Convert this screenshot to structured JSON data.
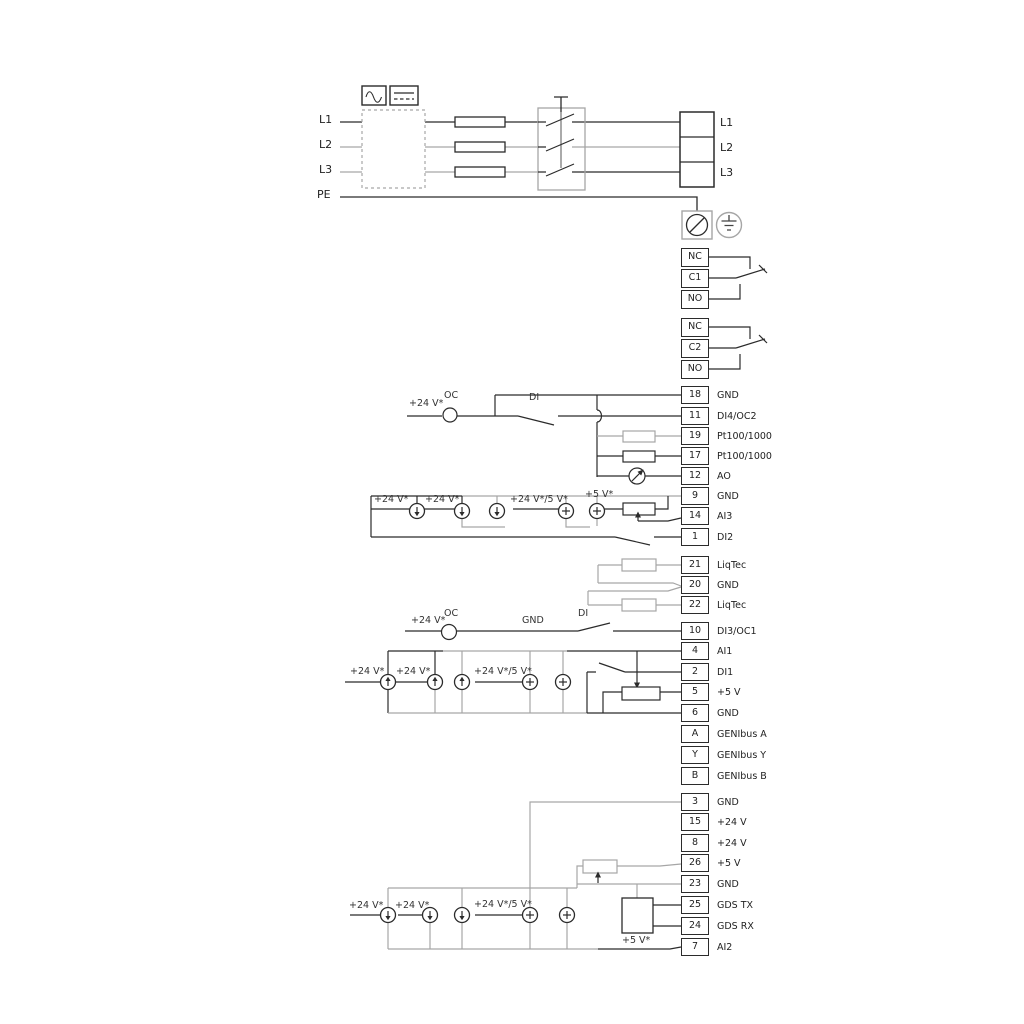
{
  "title": "Pump control wiring diagram",
  "colors": {
    "wire_dark": "#2b2b2b",
    "wire_gray": "#a6a6a6",
    "background": "#ffffff"
  },
  "power": {
    "left_labels": [
      "L1",
      "L2",
      "L3",
      "PE"
    ],
    "right_labels": [
      "L1",
      "L2",
      "L3"
    ]
  },
  "relays": {
    "relay1": [
      "NC",
      "C1",
      "NO"
    ],
    "relay2": [
      "NC",
      "C2",
      "NO"
    ]
  },
  "terminals": [
    {
      "num": "18",
      "label": "GND"
    },
    {
      "num": "11",
      "label": "DI4/OC2"
    },
    {
      "num": "19",
      "label": "Pt100/1000"
    },
    {
      "num": "17",
      "label": "Pt100/1000"
    },
    {
      "num": "12",
      "label": "AO"
    },
    {
      "num": "9",
      "label": "GND"
    },
    {
      "num": "14",
      "label": "AI3"
    },
    {
      "num": "1",
      "label": "DI2"
    },
    {
      "num": "21",
      "label": "LiqTec"
    },
    {
      "num": "20",
      "label": "GND"
    },
    {
      "num": "22",
      "label": "LiqTec"
    },
    {
      "num": "10",
      "label": "DI3/OC1"
    },
    {
      "num": "4",
      "label": "AI1"
    },
    {
      "num": "2",
      "label": "DI1"
    },
    {
      "num": "5",
      "label": "+5 V"
    },
    {
      "num": "6",
      "label": "GND"
    },
    {
      "num": "A",
      "label": "GENIbus A"
    },
    {
      "num": "Y",
      "label": "GENIbus Y"
    },
    {
      "num": "B",
      "label": "GENIbus B"
    },
    {
      "num": "3",
      "label": "GND"
    },
    {
      "num": "15",
      "label": "+24 V"
    },
    {
      "num": "8",
      "label": "+24 V"
    },
    {
      "num": "26",
      "label": "+5 V"
    },
    {
      "num": "23",
      "label": "GND"
    },
    {
      "num": "25",
      "label": "GDS TX"
    },
    {
      "num": "24",
      "label": "GDS RX"
    },
    {
      "num": "7",
      "label": "AI2"
    }
  ],
  "annotations": [
    "+24 V*",
    "OC",
    "DI",
    "+24 V*",
    "+24 V*",
    "+24 V*/5 V*",
    "+5 V*",
    "+24 V*",
    "OC",
    "GND",
    "DI",
    "+24 V*",
    "+24 V*",
    "+24 V*/5 V*",
    "+24 V*",
    "+24 V*",
    "+24 V*/5 V*",
    "+5 V*"
  ],
  "icons": {
    "ac_waveform": "sine-wave box",
    "dc": "solid-over-dashed line box",
    "pe_terminal": "circle with slash",
    "earth_ground": "circle with ground bars",
    "current_source_down": "circle with down arrow",
    "current_source_up": "circle with up arrow",
    "voltage_source_plus": "circle with plus",
    "analog_output_meter": "circle with needle arrow",
    "potentiometer": "resistor with wiper arrow",
    "fuse": "rectangle on line",
    "main_switch": "three-pole switch with handle"
  }
}
